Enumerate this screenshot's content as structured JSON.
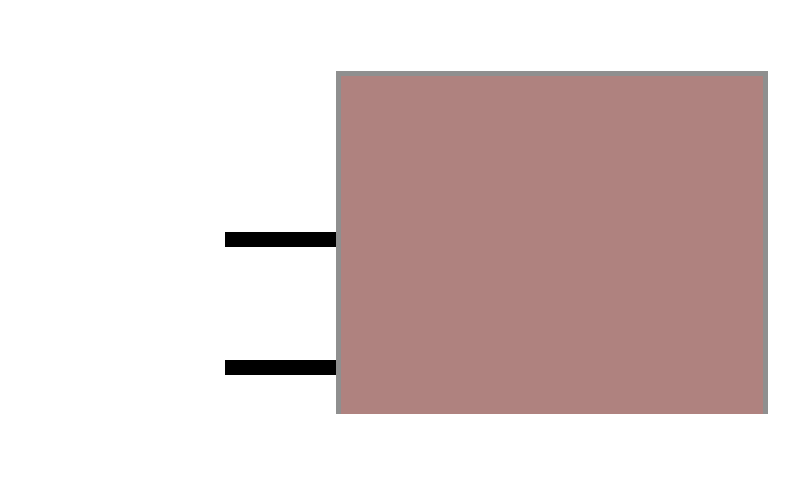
{
  "canvas": {
    "background_color": "#ffffff"
  },
  "shapes": {
    "body": {
      "name": "plug-body-rectangle",
      "fill_color": "#af827f",
      "border_color": "#8f8f8f"
    },
    "top_prong": {
      "name": "top-prong-bar",
      "fill_color": "#000000"
    },
    "bottom_prong": {
      "name": "bottom-prong-bar",
      "fill_color": "#000000"
    }
  }
}
